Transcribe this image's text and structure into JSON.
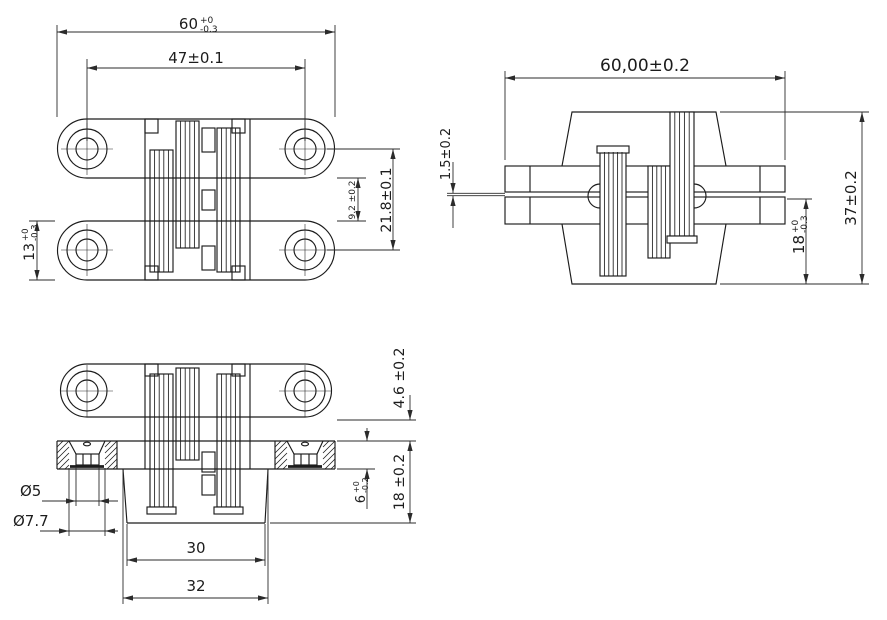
{
  "drawing": {
    "front_view": {
      "width": {
        "main": "60",
        "sup": "+0",
        "sub": "-0.3"
      },
      "hole_spacing": "47±0.1",
      "hole_row_spacing": "21.8±0.1",
      "arm_gap": "9.2 ±0.2",
      "arm_height": {
        "main": "13",
        "sup": "+0",
        "sub": "-0.3"
      }
    },
    "top_view": {
      "width": "60,00±0.2",
      "leaf_offset": "1.5±0.2",
      "total_height": "37±0.2",
      "leaf_depth": {
        "main": "18",
        "sup": "+0",
        "sub": "-0.3"
      }
    },
    "section_view": {
      "protrusion": "4.6 ±0.2",
      "recess_depth": "18 ±0.2",
      "plate_thickness": {
        "main": "6",
        "sup": "+0",
        "sub": "-0.2"
      },
      "screw_hole_dia": "Ø5",
      "screw_head_dia": "Ø7.7",
      "mortise_width_bottom": "30",
      "mortise_width_top": "32"
    },
    "colors": {
      "line": "#1c1c1c",
      "background": "#ffffff"
    }
  }
}
